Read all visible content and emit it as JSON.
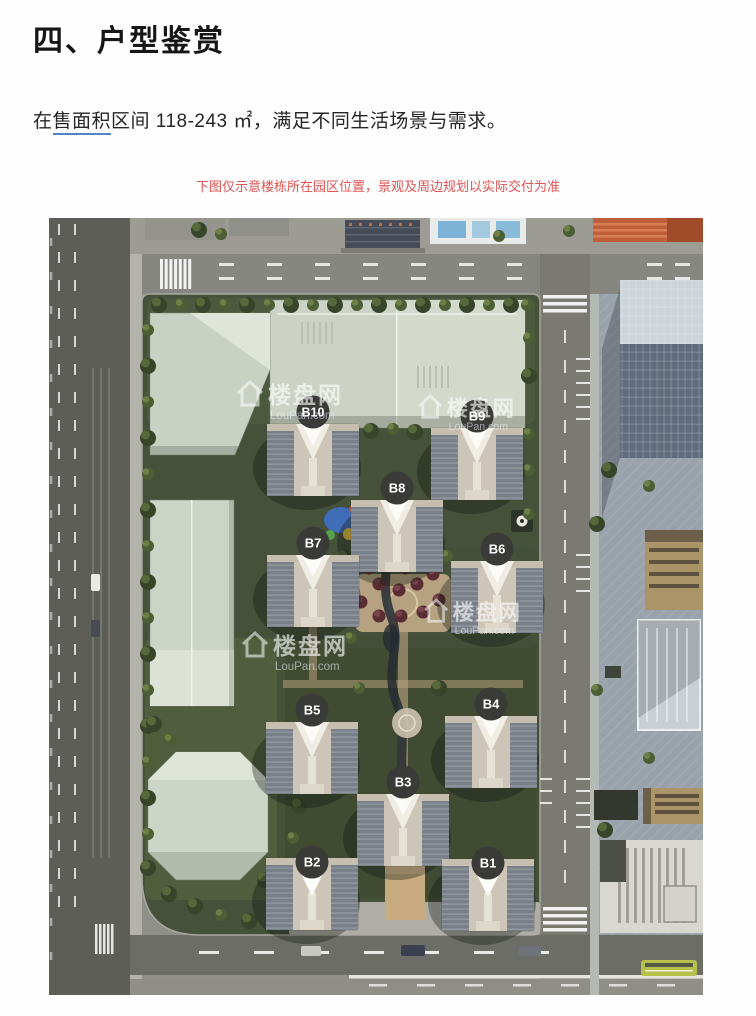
{
  "page": {
    "heading": "四、户型鉴赏",
    "intro": {
      "prefix": "在",
      "link_text": "售面积",
      "suffix": "区间 118-243 ㎡，满足不同生活场景与需求。"
    },
    "disclaimer": "下图仅示意楼栋所在园区位置，景观及周边规划以实际交付为准",
    "colors": {
      "disclaimer_red": "#e05353",
      "link_underline": "#4e86c6"
    }
  },
  "map": {
    "type": "site-plan-render",
    "watermark": {
      "name": "楼盘网",
      "domain": "LouPan.com"
    },
    "badge_color": "#3a3a38",
    "badge_text_color": "#ffffff",
    "buildings": [
      {
        "label": "B10"
      },
      {
        "label": "B9"
      },
      {
        "label": "B8"
      },
      {
        "label": "B7"
      },
      {
        "label": "B6"
      },
      {
        "label": "B5"
      },
      {
        "label": "B4"
      },
      {
        "label": "B3"
      },
      {
        "label": "B2"
      },
      {
        "label": "B1"
      }
    ]
  }
}
